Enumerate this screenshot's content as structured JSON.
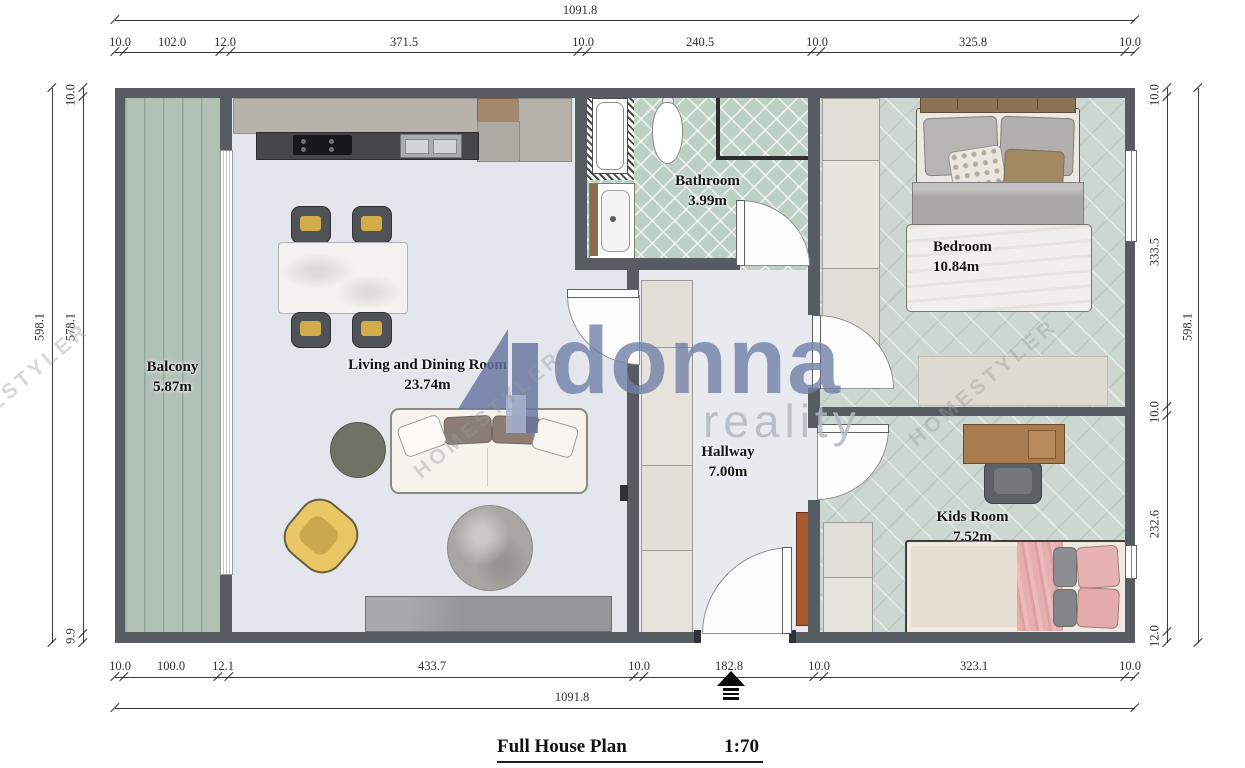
{
  "plan": {
    "title": "Full House Plan",
    "scale": "1:70",
    "north_arrow_icon": "north-arrow-icon"
  },
  "rooms": [
    {
      "id": "balcony",
      "label": "Balcony",
      "area": "5.87m"
    },
    {
      "id": "living",
      "label": "Living and Dining Room",
      "area": "23.74m"
    },
    {
      "id": "bathroom",
      "label": "Bathroom",
      "area": "3.99m"
    },
    {
      "id": "bedroom",
      "label": "Bedroom",
      "area": "10.84m"
    },
    {
      "id": "hallway",
      "label": "Hallway",
      "area": "7.00m"
    },
    {
      "id": "kids",
      "label": "Kids Room",
      "area": "7.52m"
    }
  ],
  "dimensions": {
    "top": {
      "total": "1091.8",
      "segments": [
        "10.0",
        "102.0",
        "12.0",
        "371.5",
        "10.0",
        "240.5",
        "10.0",
        "325.8",
        "10.0"
      ]
    },
    "bottom": {
      "total": "1091.8",
      "segments": [
        "10.0",
        "100.0",
        "12.1",
        "433.7",
        "10.0",
        "182.8",
        "10.0",
        "323.1",
        "10.0"
      ]
    },
    "left": {
      "total": "598.1",
      "segments": [
        "10.0",
        "578.1",
        "9.9"
      ]
    },
    "right": {
      "total": "598.1",
      "segments": [
        "10.0",
        "333.5",
        "10.0",
        "232.6",
        "12.0"
      ]
    }
  },
  "watermarks": {
    "brand": "donna",
    "brand_sub": "reality",
    "homestyler": "HOMESTYLER"
  },
  "colors": {
    "wall": "#565c62",
    "living_floor": "#e3e6ed",
    "hallway_floor": "#e8eaf0",
    "balcony_floor": "#b1c1b5",
    "bathroom_tile": "#bdd0c4",
    "bedroom_floor": "#cdd7d2",
    "brand_blue": "#717fa7",
    "accent_yellow": "#e9c765",
    "accent_pink": "#e8b2b4"
  }
}
